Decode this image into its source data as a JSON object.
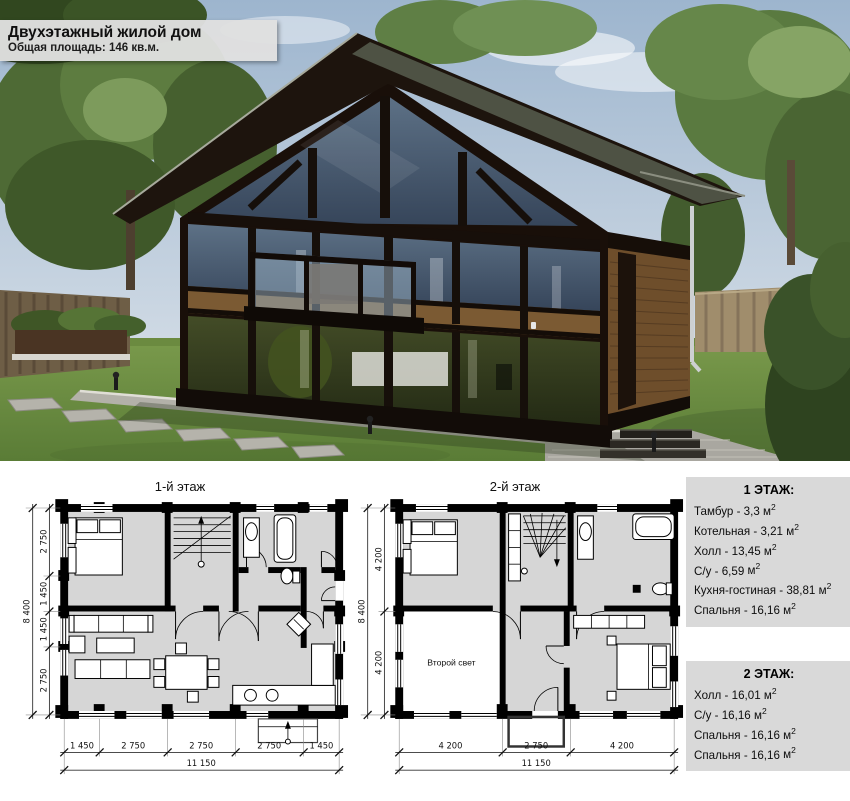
{
  "header": {
    "title": "Двухэтажный жилой дом",
    "subtitle": "Общая площадь: 146 кв.м."
  },
  "ui": {
    "dash": " - ",
    "unit": "м",
    "sup": "2"
  },
  "plans": [
    {
      "title": "1-й этаж",
      "dims_left": [
        "2 750",
        "1 450",
        "1 450",
        "2 750"
      ],
      "dims_left_total": "8 400",
      "dims_bottom": [
        "1 450",
        "2 750",
        "2 750",
        "2 750",
        "1 450"
      ],
      "dims_bottom_total": "11 150"
    },
    {
      "title": "2-й этаж",
      "room_label": "Второй свет",
      "dims_left": [
        "4 200",
        "4 200"
      ],
      "dims_left_total": "8 400",
      "dims_bottom": [
        "4 200",
        "2 750",
        "4 200"
      ],
      "dims_bottom_total": "11 150"
    }
  ],
  "floor_info": [
    {
      "title": "1 ЭТАЖ:",
      "rooms": [
        {
          "name": "Тамбур",
          "area": "3,3"
        },
        {
          "name": "Котельная",
          "area": "3,21"
        },
        {
          "name": "Холл",
          "area": "13,45"
        },
        {
          "name": "С/у",
          "area": "6,59"
        },
        {
          "name": "Кухня-гостиная",
          "area": "38,81"
        },
        {
          "name": "Спальня",
          "area": "16,16"
        }
      ]
    },
    {
      "title": "2 ЭТАЖ:",
      "rooms": [
        {
          "name": "Холл",
          "area": "16,01"
        },
        {
          "name": "С/у",
          "area": "16,16"
        },
        {
          "name": "Спальня",
          "area": "16,16"
        },
        {
          "name": "Спальня",
          "area": "16,16"
        }
      ]
    }
  ],
  "colors": {
    "info_box_bg": "#d9d9d9",
    "overlay_bg": "#e0e0e0",
    "plan_floor": "#d6d6d6",
    "house_frame": "#190f09",
    "wood": "#7b5a33",
    "lawn": "#6f9345",
    "sky": "#a3bad1"
  }
}
